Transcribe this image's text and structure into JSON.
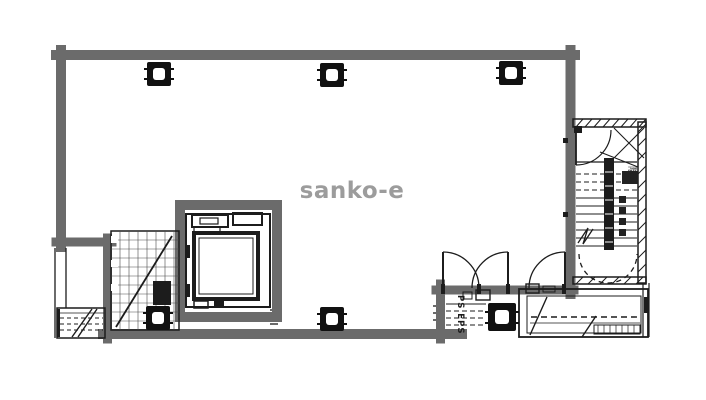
{
  "watermark": {
    "text": "sanko-e",
    "color": "#9c9c9c"
  },
  "stairwell": {
    "label": "階段"
  },
  "pipe_shaft": {
    "label": "PS EPS"
  },
  "colors": {
    "wall": "#6b6b6b",
    "line": "#1c1c1c",
    "grid": "#4a4a4a",
    "background": "#ffffff",
    "column": "#111111"
  },
  "plan": {
    "kind": "architectural-floor-plan",
    "features": [
      "main-room",
      "elevator-shaft",
      "stairwell",
      "pipe-shaft-ps-eps",
      "machine-room",
      "hatched-light-well",
      "fire-escape",
      "structural-columns"
    ],
    "column_count": 6,
    "door_count": 4
  }
}
